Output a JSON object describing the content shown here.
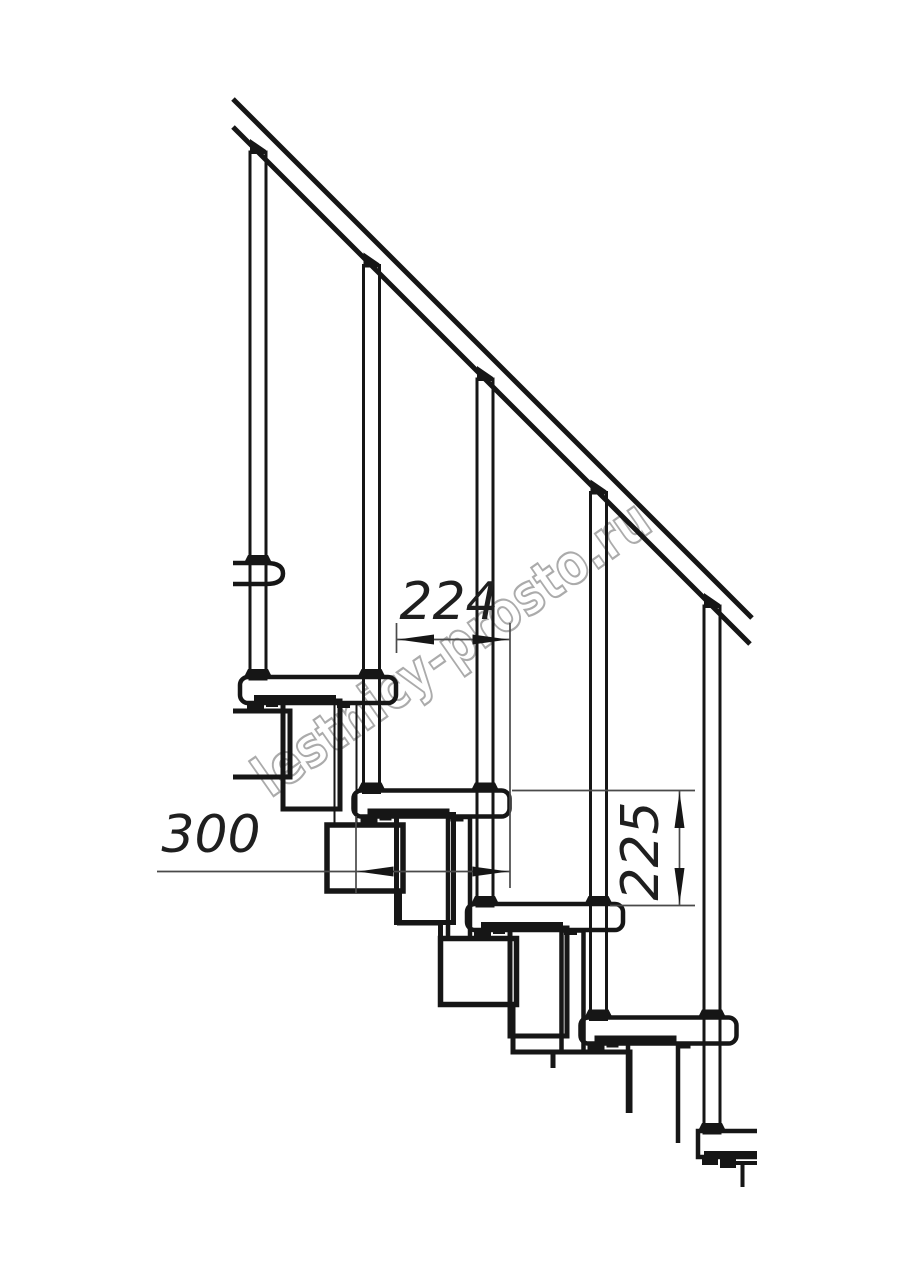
{
  "drawing": {
    "title": "staircase-side-elevation",
    "dimensions": {
      "run_between_steps": "224",
      "tread_depth": "300",
      "step_rise": "225"
    },
    "watermark": "lestnicy-prosto.ru",
    "colors": {
      "ink": "#161616",
      "dim_lines": "#4a4a4a",
      "watermark": "#ababab",
      "background": "#ffffff"
    }
  }
}
